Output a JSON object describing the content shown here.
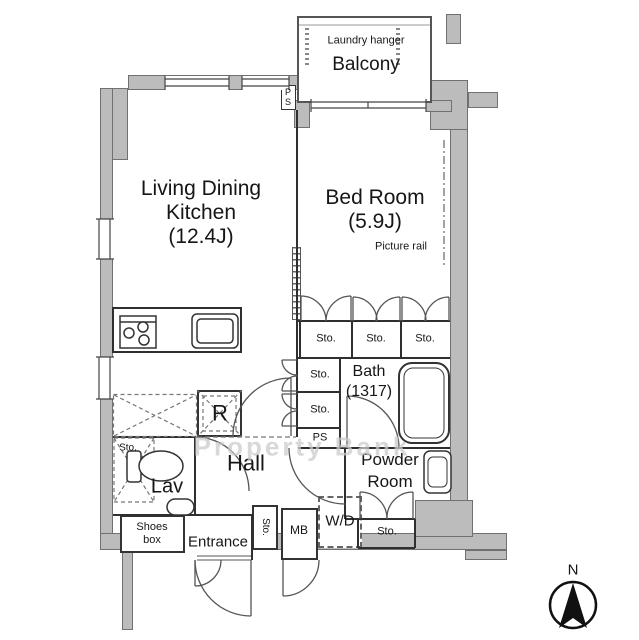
{
  "watermark": "Property Bank",
  "compass": {
    "north": "N"
  },
  "labels": {
    "balcony": "Balcony",
    "laundry_hanger": "Laundry hanger",
    "ldk_line1": "Living Dining",
    "ldk_line2": "Kitchen",
    "ldk_line3": "(12.4J)",
    "bedroom_line1": "Bed Room",
    "bedroom_line2": "(5.9J)",
    "picture_rail": "Picture rail",
    "bath_line1": "Bath",
    "bath_line2": "(1317)",
    "powder_line1": "Powder",
    "powder_line2": "Room",
    "hall": "Hall",
    "lav": "Lav",
    "entrance": "Entrance",
    "shoes_line1": "Shoes",
    "shoes_line2": "box",
    "wd": "W/D",
    "mb": "MB",
    "refrigerator": "R",
    "ps_top_line1": "P",
    "ps_top_line2": "S",
    "ps": "PS",
    "storage": "Sto."
  },
  "colors": {
    "wall_fill": "#bcbcbc",
    "wall_edge": "#707070",
    "line": "#333333",
    "watermark": "#cccccc"
  }
}
